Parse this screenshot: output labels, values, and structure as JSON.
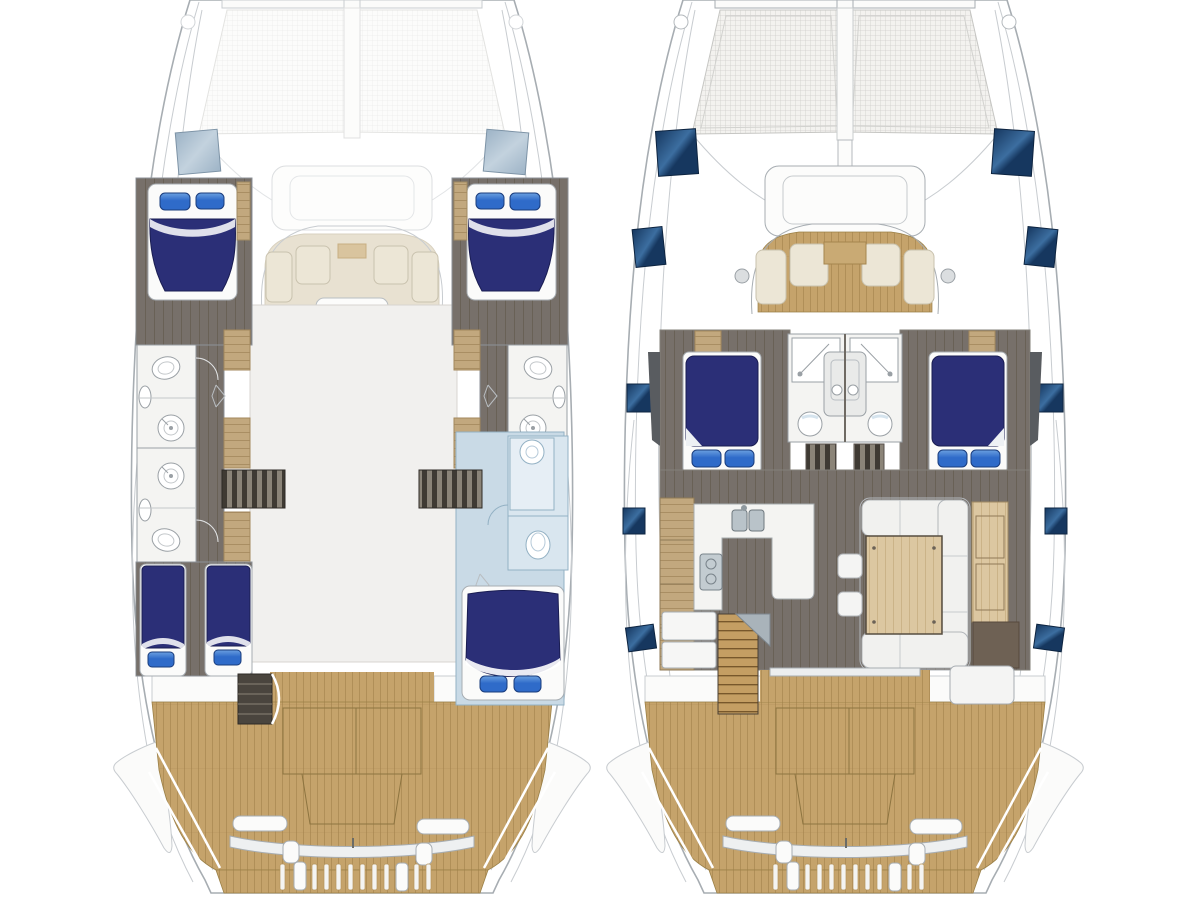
{
  "diagram": {
    "type": "boat-floor-plan",
    "vessel": "sailing catamaran layout, two deck plans side by side, bow up",
    "plans": [
      {
        "id": "lower-deck",
        "position": "left",
        "features": [
          "ghosted-bow-trampoline",
          "deck-skylight-port",
          "deck-skylight-starboard",
          "forward-cockpit-seating",
          "anchor-locker-ghost",
          "port-forward-cabin-double-bed",
          "port-forward-head",
          "port-aft-head",
          "port-aft-cabin-twin-beds",
          "starboard-forward-cabin-double-bed",
          "starboard-forward-head",
          "starboard-aft-suite-highlighted-blue",
          "central-void",
          "companionway-stairs-port",
          "companionway-stairs-starboard",
          "aft-deck-teak",
          "engine-hatch-outlines",
          "stern-beam-davits",
          "swim-platform-slats"
        ]
      },
      {
        "id": "main-deck",
        "position": "right",
        "features": [
          "bow-trampoline",
          "anchor-locker",
          "mast-post",
          "deck-hatches-navy",
          "forward-cockpit-seating",
          "port-forward-cabin-double-bed",
          "starboard-forward-cabin-double-bed",
          "twin-center-heads-with-showers",
          "hull-stairs",
          "galley-u-counter-double-sink-cooktop",
          "refrigeration-boxes",
          "companionway-stair-wood",
          "salon-u-sofa",
          "salon-table",
          "ottoman-stools",
          "starboard-sideboard",
          "nav-cabinet",
          "sliding-door",
          "aft-cockpit-seat",
          "aft-deck-teak",
          "engine-hatch-outlines",
          "stern-beam-davits",
          "swim-platform-slats"
        ]
      }
    ],
    "counts": {
      "deck_hatches_navy": 10,
      "cabins_lower_deck": 4,
      "heads_lower_deck": 3,
      "twin_beds": 2,
      "double_beds_shown": 5
    }
  },
  "colors": {
    "background": "#ffffff",
    "hullOutline": "#a7adb2",
    "sheerLine": "#c8ccd0",
    "ghostLine": "#e2e4e6",
    "teak": "#c5a36b",
    "teakLine": "#9a7a44",
    "deckFloorDark": "#77706a",
    "deckFloorLine": "#696156",
    "woodCabinet": "#c2a87e",
    "woodCabinetLine": "#a3875c",
    "woodLight": "#dcc7a1",
    "woodLightLine": "#c7ae82",
    "navyBedding": "#2b2f77",
    "navyBeddingEdge": "#1a1d52",
    "pillowBlue": "#2f6bc9",
    "pillowEdge": "#1a3c7c",
    "cushionCream": "#ece6d6",
    "cushionEdge": "#c9c2ae",
    "glassWindow": "#9db3c6",
    "hatchNavy": "#16375f",
    "hatchLight": "#3c6ea0",
    "bathFloor": "#f4f4f2",
    "fixtureOutline": "#9aa0a5",
    "lightBlueCabin": "#c9dae6",
    "lightBlueLine": "#93b1c4",
    "lightBlueInner": "#d9e6ef",
    "voidFill": "#f1f0ee",
    "voidEdge": "#d8d5d0",
    "panelWhite": "#fbfbfa",
    "steel": "#b9c3c9",
    "steelEdge": "#6e787e",
    "darkCabinet": "#6e6154",
    "stairDark": "#3f3a33",
    "stairLight": "#8b8478",
    "stairWood": "#c49e63",
    "stairWoodLine": "#77572b",
    "meshFaintBg": "#fcfcfb",
    "meshFaintLine": "#ececeb",
    "meshStrongBg": "#f3f2ef",
    "meshStrongLine": "#cfcecb"
  }
}
